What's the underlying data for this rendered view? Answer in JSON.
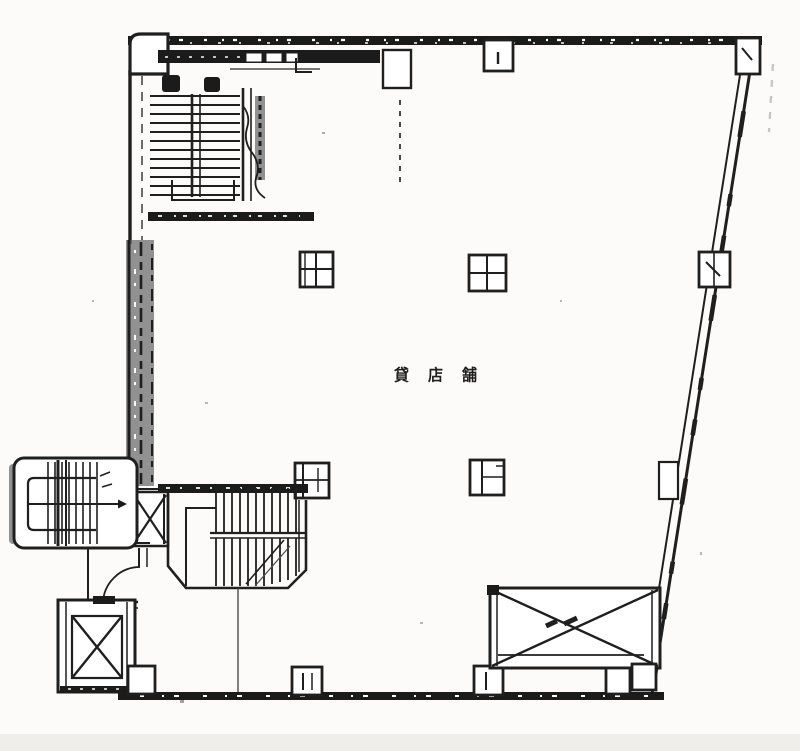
{
  "labels": {
    "center": "貸店舗"
  },
  "colors": {
    "ink": "#1f1f1f",
    "paper": "#fcfbf9",
    "scan_edge_band": "#f0eeea",
    "wall_gray": "#6e6e6e"
  },
  "symbols": {
    "interior_staircase": "staircase-icon",
    "exterior_staircase": "exterior-staircase-icon",
    "elevator": "elevator-crossbox-icon",
    "column": "column-grid-icon",
    "void_area": "crossed-void-icon",
    "door": "door-swing-arc-icon"
  }
}
